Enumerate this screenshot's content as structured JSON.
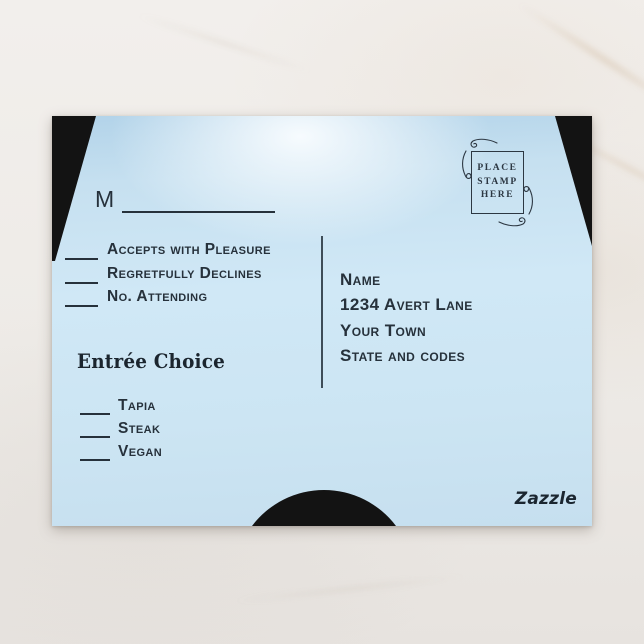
{
  "postcard": {
    "m_line": {
      "label": "M"
    },
    "rsvp_options": [
      {
        "label": "Accepts with Pleasure"
      },
      {
        "label": "Regretfully Declines"
      },
      {
        "label": "No. Attending"
      }
    ],
    "entree": {
      "heading": "Entrée Choice",
      "options": [
        {
          "label": "Tapia"
        },
        {
          "label": "Steak"
        },
        {
          "label": "Vegan"
        }
      ]
    },
    "address": {
      "lines": [
        "Name",
        "1234 Avert Lane",
        "Your Town",
        "State and codes"
      ]
    },
    "stamp": {
      "lines": [
        "PLACE",
        "STAMP",
        "HERE"
      ]
    },
    "brand": {
      "logo_text": "Zazzle"
    },
    "colors": {
      "card_blue": "#cde5f3",
      "card_highlight": "#fafdff",
      "ink": "#26313b",
      "corner_black": "#131313",
      "marble": "#edeae6"
    }
  }
}
